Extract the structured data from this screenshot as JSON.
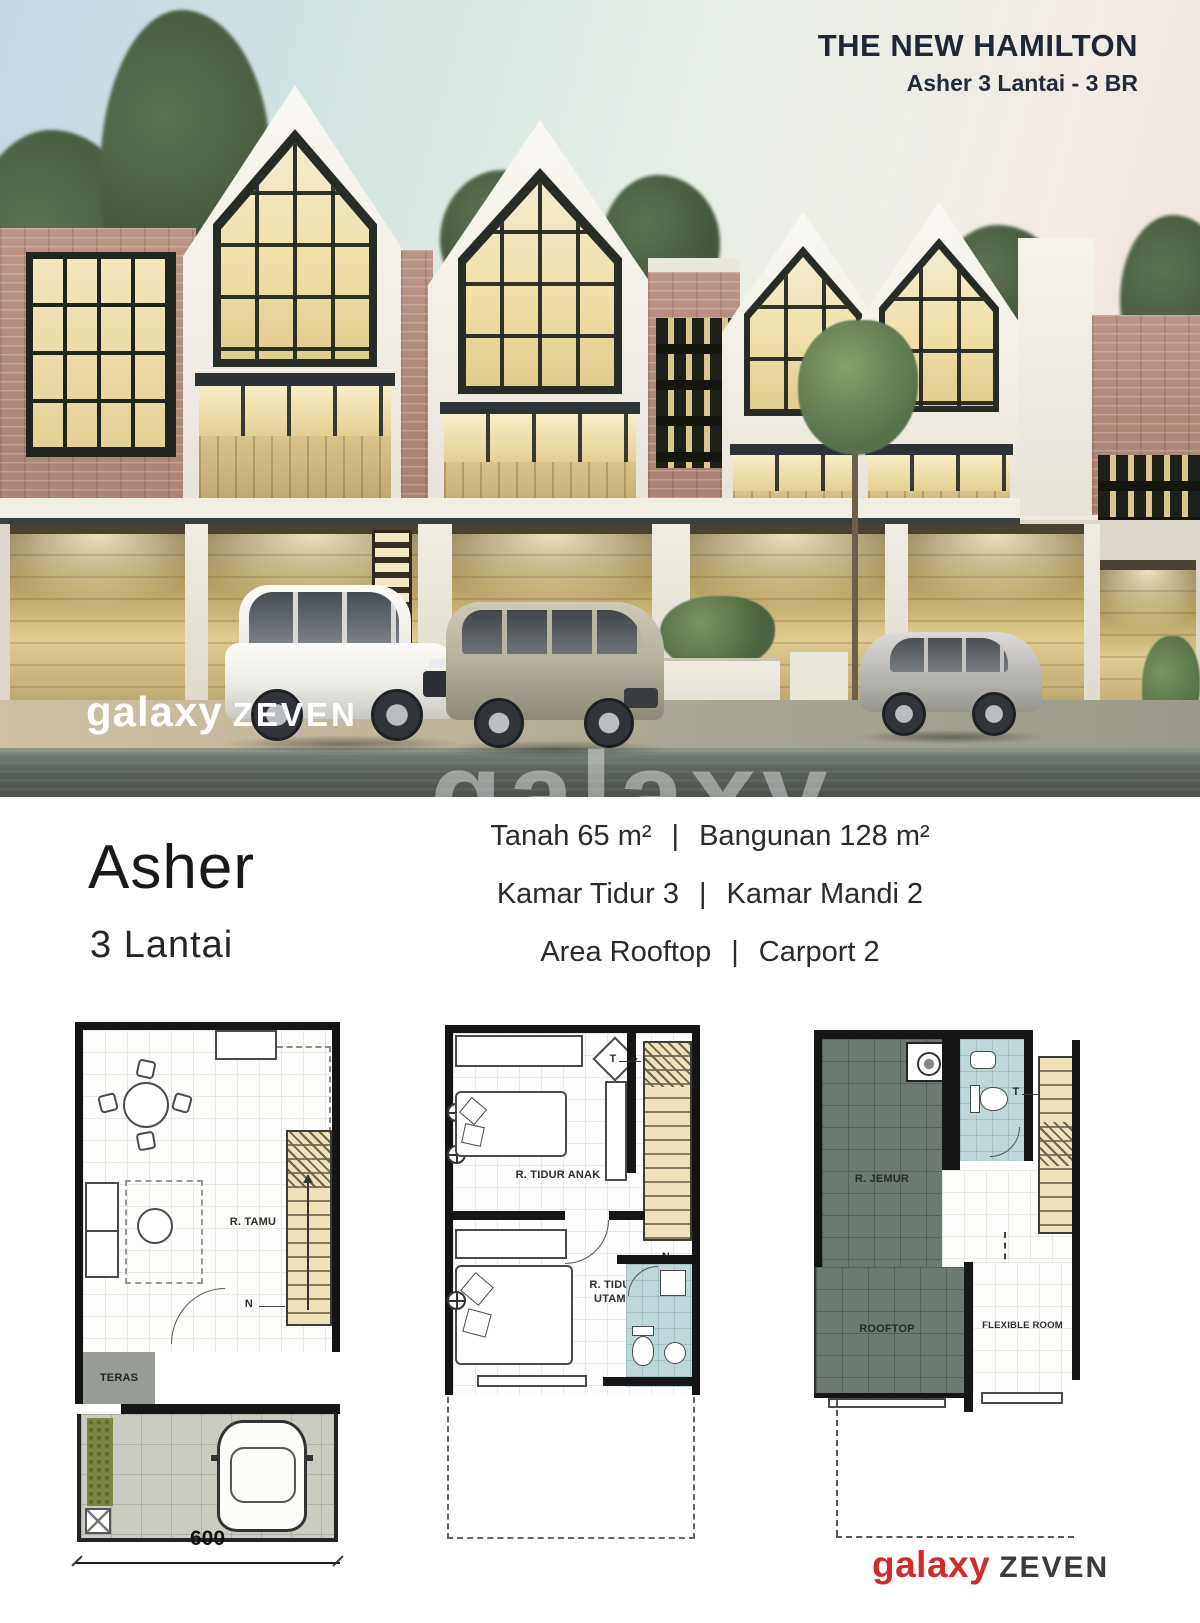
{
  "header": {
    "title": "THE NEW HAMILTON",
    "subtitle": "Asher 3 Lantai - 3 BR"
  },
  "photo": {
    "watermark_left_brand": "galaxy",
    "watermark_left_suffix": "ZEVEN",
    "watermark_center": "galaxy"
  },
  "info": {
    "product_name": "Asher",
    "product_floors": "3 Lantai",
    "separator": "|",
    "specs": [
      {
        "left": "Tanah 65 m²",
        "right": "Bangunan 128 m²"
      },
      {
        "left": "Kamar Tidur 3",
        "right": "Kamar Mandi 2"
      },
      {
        "left": "Area Rooftop",
        "right": "Carport 2"
      }
    ]
  },
  "floorplans": {
    "plan1": {
      "room": "R. TAMU",
      "teras": "TERAS",
      "north": "N",
      "dimension": "600"
    },
    "plan2": {
      "room1": "R. TIDUR ANAK",
      "room2": "R. TIDUR\nUTAMA",
      "north": "N",
      "stair_marker": "T"
    },
    "plan3": {
      "jemur": "R. JEMUR",
      "rooftop": "ROOFTOP",
      "flexible": "FLEXIBLE ROOM",
      "stair_marker": "T"
    }
  },
  "footer": {
    "brand": "galaxy",
    "brand_suffix": "ZEVEN"
  },
  "colors": {
    "accent_red": "#d52b28",
    "heading_dark": "#1e2736",
    "bathroom_blue": "#bed8da",
    "rooftop_tile": "#6d7a72",
    "stair_tan": "#eee2b8"
  }
}
